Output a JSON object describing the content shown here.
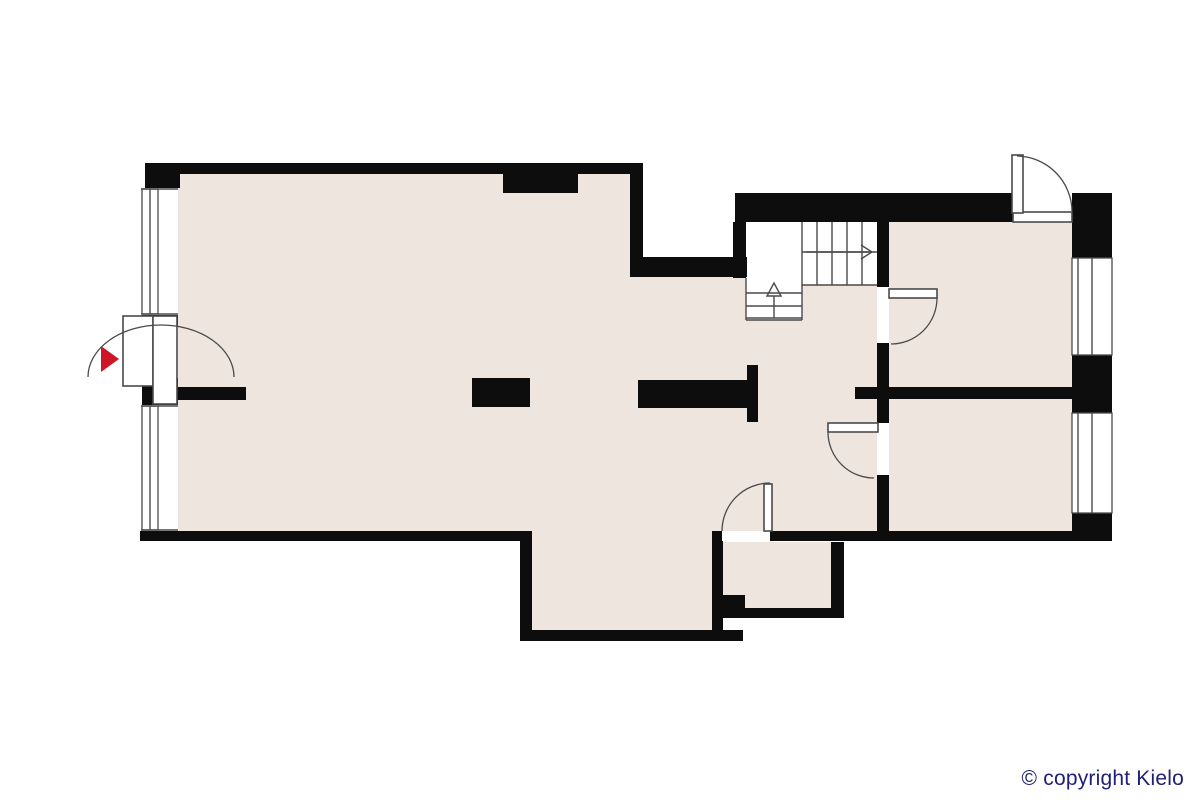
{
  "footer": {
    "copyright": "© copyright Kielo"
  },
  "colors": {
    "background": "#FFFFFF",
    "floor": "#EDE5DE",
    "wall": "#0D0D0D",
    "line": "#4A4A4A",
    "entrance_arrow_red": "#CF1528",
    "copyright_text": "#1F1F76"
  },
  "floor_plan": {
    "type": "apartment-floor-plan",
    "icons": [
      "entrance-arrow-icon",
      "stairs-up-arrow-icon",
      "stairs-direction-arrow-icon"
    ],
    "elements": {
      "exterior_doors": 2,
      "interior_doors": 3,
      "windows_left_wall": 2,
      "windows_right_wall": 2,
      "staircase": "L-shaped with landing, up direction marked"
    }
  }
}
